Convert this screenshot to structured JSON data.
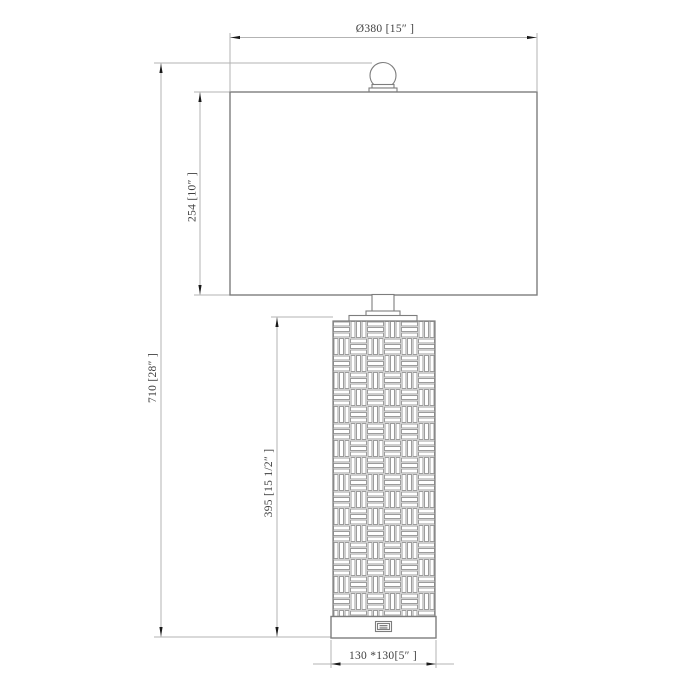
{
  "drawing": {
    "kind": "table-lamp dimension drawing",
    "dimensions": {
      "shade_width": "Ø380 [15″ ]",
      "shade_height": "254 [10″ ]",
      "total_height": "710 [28″ ]",
      "body_height": "395 [15 1/2″ ]",
      "base_size": "130 *130[5″ ]"
    },
    "colors": {
      "object_line": "#7d7d7d",
      "pattern_line": "#9c9c9c",
      "dimension_line": "#b3b3b3",
      "arrow": "#1a1a1a",
      "text": "#3f3f3f",
      "background": "#ffffff"
    }
  }
}
